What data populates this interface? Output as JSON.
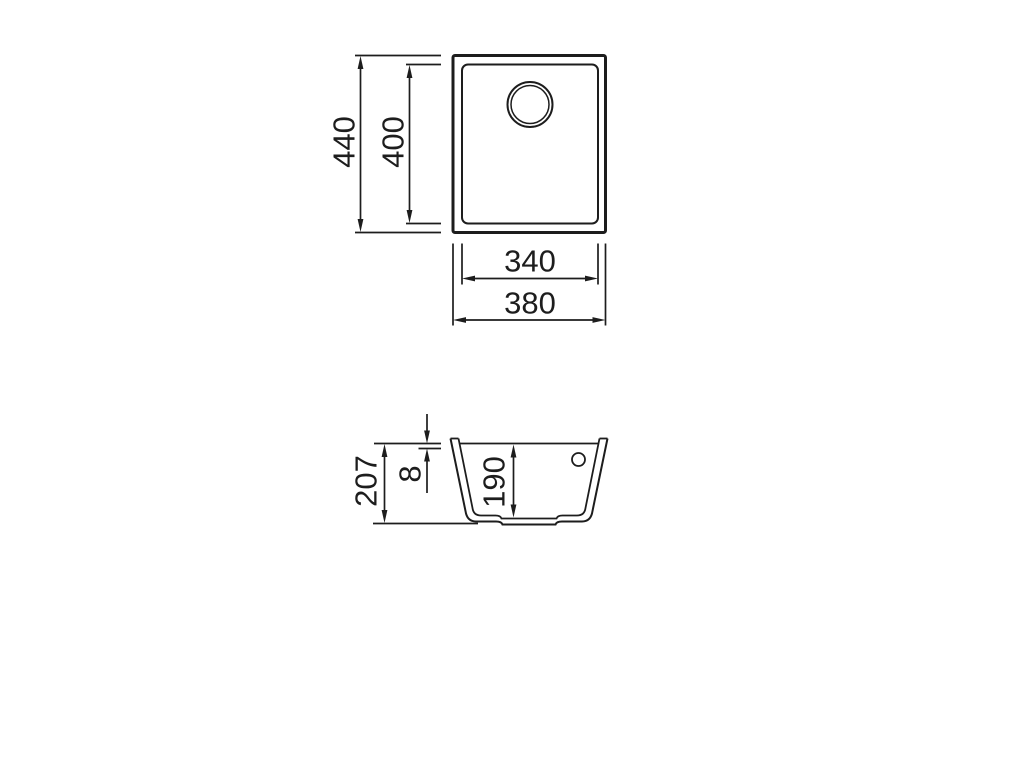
{
  "colors": {
    "line": "#1d1d1d",
    "text": "#1d1d1d",
    "background": "#ffffff"
  },
  "top_view": {
    "dims": {
      "outer_height": "440",
      "bowl_height": "400",
      "bowl_width": "340",
      "outer_width": "380"
    }
  },
  "section_view": {
    "dims": {
      "overall_height": "207",
      "rim": "8",
      "bowl_depth": "190"
    }
  }
}
